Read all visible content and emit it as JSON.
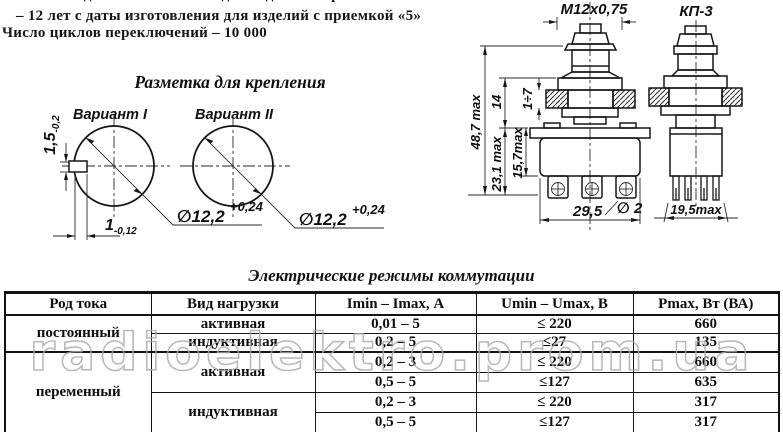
{
  "top_text": {
    "line1": "– 14 лет с даты изготовления для изделий с приемкой «1»",
    "line2": "– 12 лет с даты изготовления для изделий с приемкой «5»",
    "line3": "Число циклов переключений – 10 000"
  },
  "mounting": {
    "title": "Разметка для крепления",
    "variant1": "Вариант I",
    "variant2": "Вариант II",
    "slot_height": "1,5",
    "slot_height_tol": "-0,2",
    "slot_depth": "1",
    "slot_depth_tol": "-0,12",
    "hole_dia": "∅12,2",
    "hole_dia_tol": "+0,24"
  },
  "drawing": {
    "thread": "М12х0,75",
    "model": "КП-3",
    "height_total": "48,7 max",
    "height_14": "14",
    "panel_range": "1÷7",
    "height_231": "23,1 max",
    "height_157": "15,7max",
    "width_295": "29,5",
    "hole_dia": "∅ 2",
    "width_195": "19,5max"
  },
  "table": {
    "title": "Электрические режимы коммутации",
    "headers": [
      "Род тока",
      "Вид нагрузки",
      "Imin – Imax, А",
      "Umin – Umax, В",
      "Pmax, Вт (ВА)"
    ],
    "rows": [
      {
        "current": "постоянный",
        "load": "активная",
        "i": "0,01 – 5",
        "u": "≤ 220",
        "p": "660"
      },
      {
        "load": "индуктивная",
        "i": "0,2 – 5",
        "u": "≤27",
        "p": "135"
      },
      {
        "current": "переменный",
        "load": "активная",
        "i": "0,2 – 3",
        "u": "≤ 220",
        "p": "660"
      },
      {
        "i": "0,5 – 5",
        "u": "≤127",
        "p": "635"
      },
      {
        "load": "индуктивная",
        "i": "0,2 – 3",
        "u": "≤ 220",
        "p": "317"
      },
      {
        "i": "0,5 – 5",
        "u": "≤127",
        "p": "317"
      }
    ]
  },
  "watermark": "radioelektro.prom.ua"
}
